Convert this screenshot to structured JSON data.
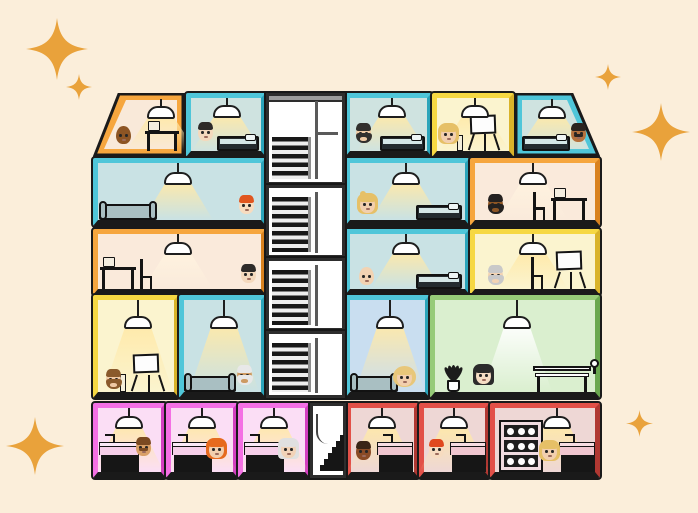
{
  "illustration": {
    "description": "Cutaway dollhouse-style illustration of a five-storey apartment building with 21 emoji-style residents, pendant lamps, furniture, a central stairwell and gold sparkles on a cream background",
    "background": "#fbeeda",
    "line_color": "#1a1a1a",
    "sparkles": {
      "color": "#e9a23b",
      "items": [
        {
          "x": 26,
          "y": 18,
          "size": 62
        },
        {
          "x": 66,
          "y": 74,
          "size": 26
        },
        {
          "x": 595,
          "y": 64,
          "size": 26
        },
        {
          "x": 632,
          "y": 103,
          "size": 58
        },
        {
          "x": 626,
          "y": 410,
          "size": 27
        },
        {
          "x": 6,
          "y": 417,
          "size": 58
        }
      ]
    },
    "stairwell": {
      "x": 266,
      "y": 93,
      "width": 79,
      "height": 305,
      "frame": "#2d2d2d",
      "roof": "#9c9c9c",
      "sections": [
        {
          "y": 93,
          "h": 92,
          "steps_top_pct": 48,
          "roof": true,
          "shelf": true
        },
        {
          "y": 185,
          "h": 73,
          "steps_top_pct": 14,
          "roof": false,
          "shelf": false
        },
        {
          "y": 258,
          "h": 73,
          "steps_top_pct": 14,
          "roof": false,
          "shelf": false
        },
        {
          "y": 331,
          "h": 67,
          "steps_top_pct": 14,
          "roof": false,
          "shelf": false
        }
      ],
      "mini": {
        "x": 310,
        "y": 403,
        "width": 36,
        "height": 75,
        "steps": 6
      }
    },
    "rooms": [
      {
        "id": "f1-attic-left",
        "floor": 1,
        "x": 93,
        "y": 93,
        "w": 92,
        "h": 64,
        "frame": "#f6a63e",
        "frame_dark": "#d9821f",
        "interior": "#f9e9d9",
        "slant": "left",
        "lamp": {
          "cx": 62,
          "cord": 7,
          "cone": "#ffe9a8"
        },
        "furniture": [
          {
            "type": "desk",
            "left": 46,
            "width": 34,
            "height": 32
          }
        ],
        "people": [
          {
            "name": "man-dark-skin-bald",
            "skin": "#8d5524",
            "hair": "",
            "style": "bald",
            "beard": false,
            "mustache": false,
            "left": 16,
            "bottom": 7
          }
        ]
      },
      {
        "id": "f1-bedroom-2",
        "floor": 1,
        "x": 186,
        "y": 93,
        "w": 80,
        "h": 64,
        "frame": "#4fc6d9",
        "frame_dark": "#2ba4ba",
        "interior": "#cfe3e0",
        "slant": "",
        "lamp": {
          "cx": 36,
          "cord": 7,
          "cone": "#ffe9a8"
        },
        "furniture": [
          {
            "type": "bed",
            "left": 26,
            "width": 42,
            "height": 15
          }
        ],
        "people": [
          {
            "name": "man-black-hair",
            "skin": "#f4d9bd",
            "hair": "#2e2b29",
            "style": "short",
            "beard": false,
            "mustache": false,
            "left": 6,
            "bottom": 10
          }
        ]
      },
      {
        "id": "f1-bedroom-3",
        "floor": 1,
        "x": 345,
        "y": 93,
        "w": 87,
        "h": 64,
        "frame": "#4fc6d9",
        "frame_dark": "#2ba4ba",
        "interior": "#cfe3e0",
        "slant": "",
        "lamp": {
          "cx": 42,
          "cord": 7,
          "cone": "#ffe9a8"
        },
        "furniture": [
          {
            "type": "bed",
            "left": 30,
            "width": 45,
            "height": 15
          }
        ],
        "people": [
          {
            "name": "man-dark-beard",
            "skin": "#efc9a4",
            "hair": "#33302e",
            "style": "short",
            "beard": true,
            "mustache": false,
            "left": 5,
            "bottom": 9
          }
        ]
      },
      {
        "id": "f1-studio-yellow",
        "floor": 1,
        "x": 432,
        "y": 93,
        "w": 82,
        "h": 64,
        "frame": "#f6d843",
        "frame_dark": "#d9b32a",
        "interior": "#fbf4cf",
        "slant": "",
        "lamp": {
          "cx": 38,
          "cord": 7,
          "cone": "#ffe9a8"
        },
        "furniture": [
          {
            "type": "easel",
            "left": 28,
            "width": 38,
            "height": 36
          },
          {
            "type": "stool",
            "left": 20,
            "width": 6,
            "height": 16
          }
        ],
        "people": [
          {
            "name": "woman-blonde",
            "skin": "#f2cfae",
            "hair": "#e6c067",
            "style": "long",
            "beard": false,
            "mustache": false,
            "left": 3,
            "bottom": 8
          }
        ]
      },
      {
        "id": "f1-attic-right",
        "floor": 1,
        "x": 514,
        "y": 93,
        "w": 86,
        "h": 64,
        "frame": "#4fc6d9",
        "frame_dark": "#2ba4ba",
        "interior": "#cfe3e0",
        "slant": "right",
        "lamp": {
          "cx": 32,
          "cord": 7,
          "cone": "#ffe9a8"
        },
        "furniture": [
          {
            "type": "bed",
            "left": 2,
            "width": 48,
            "height": 15
          }
        ],
        "people": [
          {
            "name": "man-mustache-medium-skin",
            "skin": "#b5713d",
            "hair": "#2b2420",
            "style": "short",
            "beard": false,
            "mustache": true,
            "left": 50,
            "bottom": 9
          }
        ]
      },
      {
        "id": "f2-bedroom-left",
        "floor": 2,
        "x": 93,
        "y": 158,
        "w": 173,
        "h": 68,
        "frame": "#4fc6d9",
        "frame_dark": "#2ba4ba",
        "interior": "#c9e2e4",
        "slant": "",
        "lamp": {
          "cx": 80,
          "cord": 9,
          "cone": "#ffe9a8"
        },
        "furniture": [
          {
            "type": "couch",
            "left": 1,
            "width": 58,
            "height": 16
          }
        ],
        "people": [
          {
            "name": "boy-red-hair",
            "skin": "#f7dcc0",
            "hair": "#e0561f",
            "style": "short",
            "beard": false,
            "mustache": false,
            "left": 140,
            "bottom": 6
          }
        ]
      },
      {
        "id": "f2-bedroom-mid",
        "floor": 2,
        "x": 345,
        "y": 158,
        "w": 125,
        "h": 68,
        "frame": "#4fc6d9",
        "frame_dark": "#2ba4ba",
        "interior": "#c9e2e4",
        "slant": "",
        "lamp": {
          "cx": 56,
          "cord": 9,
          "cone": "#ffe9a8"
        },
        "furniture": [
          {
            "type": "bed",
            "left": 66,
            "width": 46,
            "height": 15
          }
        ],
        "people": [
          {
            "name": "woman-blonde-ponytail",
            "skin": "#f2cfae",
            "hair": "#e6c067",
            "style": "ponytail",
            "beard": false,
            "mustache": false,
            "left": 9,
            "bottom": 7
          }
        ]
      },
      {
        "id": "f2-office-orange",
        "floor": 2,
        "x": 470,
        "y": 158,
        "w": 130,
        "h": 68,
        "frame": "#f6a63e",
        "frame_dark": "#d9821f",
        "interior": "#faeadb",
        "slant": "",
        "lamp": {
          "cx": 58,
          "cord": 9,
          "cone": "#fff3df"
        },
        "furniture": [
          {
            "type": "chair",
            "left": 58,
            "width": 14,
            "height": 28
          },
          {
            "type": "desk",
            "left": 76,
            "width": 36,
            "height": 34
          }
        ],
        "people": [
          {
            "name": "man-dark-skin-beard",
            "skin": "#8d5524",
            "hair": "#242120",
            "style": "short",
            "beard": true,
            "mustache": false,
            "left": 12,
            "bottom": 7
          }
        ]
      },
      {
        "id": "f3-office-left",
        "floor": 3,
        "x": 93,
        "y": 229,
        "w": 173,
        "h": 66,
        "frame": "#f6a63e",
        "frame_dark": "#d9821f",
        "interior": "#faeadb",
        "slant": "",
        "lamp": {
          "cx": 80,
          "cord": 8,
          "cone": "#fff3df"
        },
        "furniture": [
          {
            "type": "desk",
            "left": 2,
            "width": 36,
            "height": 34
          },
          {
            "type": "chair",
            "left": 42,
            "width": 14,
            "height": 30
          }
        ],
        "people": [
          {
            "name": "boy-black-hair",
            "skin": "#f4d9bd",
            "hair": "#2e2b29",
            "style": "short",
            "beard": false,
            "mustache": false,
            "left": 142,
            "bottom": 6
          }
        ]
      },
      {
        "id": "f3-bedroom-mid",
        "floor": 3,
        "x": 345,
        "y": 229,
        "w": 125,
        "h": 66,
        "frame": "#4fc6d9",
        "frame_dark": "#2ba4ba",
        "interior": "#c9e2e4",
        "slant": "",
        "lamp": {
          "cx": 56,
          "cord": 8,
          "cone": "#ffe9a8"
        },
        "furniture": [
          {
            "type": "bed",
            "left": 66,
            "width": 46,
            "height": 15
          }
        ],
        "people": [
          {
            "name": "older-person-bald",
            "skin": "#f2d3b3",
            "hair": "",
            "style": "bald",
            "beard": false,
            "mustache": false,
            "left": 8,
            "bottom": 4
          }
        ]
      },
      {
        "id": "f3-studio-yellow",
        "floor": 3,
        "x": 470,
        "y": 229,
        "w": 130,
        "h": 66,
        "frame": "#f6d843",
        "frame_dark": "#d9b32a",
        "interior": "#fbf4cf",
        "slant": "",
        "lamp": {
          "cx": 58,
          "cord": 8,
          "cone": "#ffe9a8"
        },
        "furniture": [
          {
            "type": "chair",
            "left": 56,
            "width": 14,
            "height": 32
          },
          {
            "type": "easel",
            "left": 76,
            "width": 38,
            "height": 38
          }
        ],
        "people": [
          {
            "name": "older-man-gray-beard",
            "skin": "#f2d3b3",
            "hair": "#c9c9c9",
            "style": "short",
            "beard": true,
            "mustache": false,
            "left": 12,
            "bottom": 5
          }
        ]
      },
      {
        "id": "f4-studio-yellow",
        "floor": 4,
        "x": 93,
        "y": 295,
        "w": 86,
        "h": 103,
        "frame": "#f6d843",
        "frame_dark": "#d9b32a",
        "interior": "#fbf4cf",
        "slant": "",
        "lamp": {
          "cx": 40,
          "cord": 16,
          "cone": "#ffe9a8"
        },
        "furniture": [
          {
            "type": "easel",
            "left": 30,
            "width": 40,
            "height": 38
          },
          {
            "type": "stool",
            "left": 22,
            "width": 6,
            "height": 18
          }
        ],
        "people": [
          {
            "name": "man-brown-beard",
            "skin": "#efc9a4",
            "hair": "#8a5a2b",
            "style": "short",
            "beard": true,
            "mustache": false,
            "left": 7,
            "bottom": 4
          }
        ]
      },
      {
        "id": "f4-lounge-teal",
        "floor": 4,
        "x": 179,
        "y": 295,
        "w": 87,
        "h": 103,
        "frame": "#4fc6d9",
        "frame_dark": "#2ba4ba",
        "interior": "#c9e2e4",
        "slant": "",
        "lamp": {
          "cx": 40,
          "cord": 16,
          "cone": "#ffe9a8"
        },
        "furniture": [
          {
            "type": "couch",
            "left": 0,
            "width": 52,
            "height": 16
          }
        ],
        "people": [
          {
            "name": "older-man-white-beard",
            "skin": "#cd9a62",
            "hair": "#e8e8e8",
            "style": "short",
            "beard": true,
            "mustache": false,
            "left": 52,
            "bottom": 8
          }
        ]
      },
      {
        "id": "f4-lounge-blue",
        "floor": 4,
        "x": 345,
        "y": 295,
        "w": 85,
        "h": 103,
        "frame": "#4fc6d9",
        "frame_dark": "#2ba4ba",
        "interior": "#c9def0",
        "slant": "",
        "lamp": {
          "cx": 40,
          "cord": 16,
          "cone": "#ffe9a8"
        },
        "furniture": [
          {
            "type": "couch",
            "left": 0,
            "width": 48,
            "height": 16
          }
        ],
        "people": [
          {
            "name": "woman-blonde-curly",
            "skin": "#f2cfae",
            "hair": "#e8c77a",
            "style": "curly",
            "beard": false,
            "mustache": false,
            "left": 46,
            "bottom": 6
          }
        ]
      },
      {
        "id": "f4-lounge-green",
        "floor": 4,
        "x": 430,
        "y": 295,
        "w": 170,
        "h": 103,
        "frame": "#96cb78",
        "frame_dark": "#6aa84f",
        "interior": "#daefcf",
        "slant": "",
        "lamp": {
          "cx": 82,
          "cord": 16,
          "cone": "#ffffff"
        },
        "furniture": [
          {
            "type": "plant",
            "left": 8,
            "width": 22,
            "height": 44
          },
          {
            "type": "bench",
            "left": 98,
            "width": 58,
            "height": 26
          }
        ],
        "people": [
          {
            "name": "woman-black-bob",
            "skin": "#f5ddc4",
            "hair": "#2b2b2b",
            "style": "bob",
            "beard": false,
            "mustache": false,
            "left": 40,
            "bottom": 8
          }
        ]
      },
      {
        "id": "f5-pink-1",
        "floor": 5,
        "x": 93,
        "y": 403,
        "w": 73,
        "h": 75,
        "frame": "#f470e4",
        "frame_dark": "#d33fc0",
        "interior": "#fbdef5",
        "slant": "",
        "lamp": {
          "cx": 31,
          "cord": 8,
          "cone": "#ffe9a8"
        },
        "furniture": [
          {
            "type": "counter",
            "left": 1,
            "width": 40,
            "height": 40,
            "variant": "pink"
          }
        ],
        "people": [
          {
            "name": "man-brown-mustache",
            "skin": "#d9a066",
            "hair": "#7b4a21",
            "style": "short",
            "beard": false,
            "mustache": true,
            "left": 37,
            "bottom": 16
          }
        ]
      },
      {
        "id": "f5-pink-2",
        "floor": 5,
        "x": 166,
        "y": 403,
        "w": 72,
        "h": 75,
        "frame": "#f470e4",
        "frame_dark": "#d33fc0",
        "interior": "#fbdef5",
        "slant": "",
        "lamp": {
          "cx": 31,
          "cord": 8,
          "cone": "#ffe9a8"
        },
        "furniture": [
          {
            "type": "counter",
            "left": 1,
            "width": 40,
            "height": 40,
            "variant": "pink"
          }
        ],
        "people": [
          {
            "name": "woman-orange-hair",
            "skin": "#f2cfae",
            "hair": "#e66a1e",
            "style": "long",
            "beard": false,
            "mustache": false,
            "left": 37,
            "bottom": 14
          }
        ]
      },
      {
        "id": "f5-pink-3",
        "floor": 5,
        "x": 238,
        "y": 403,
        "w": 72,
        "h": 75,
        "frame": "#f470e4",
        "frame_dark": "#d33fc0",
        "interior": "#fbdef5",
        "slant": "",
        "lamp": {
          "cx": 31,
          "cord": 8,
          "cone": "#ffe9a8"
        },
        "furniture": [
          {
            "type": "counter",
            "left": 1,
            "width": 40,
            "height": 40,
            "variant": "pink"
          }
        ],
        "people": [
          {
            "name": "older-woman-white-hair",
            "skin": "#f2d3b8",
            "hair": "#e0e0e0",
            "style": "bob",
            "beard": false,
            "mustache": false,
            "left": 37,
            "bottom": 14
          }
        ]
      },
      {
        "id": "f5-red-1",
        "floor": 5,
        "x": 346,
        "y": 403,
        "w": 73,
        "h": 75,
        "frame": "#e25048",
        "frame_dark": "#b03832",
        "interior": "#eed7d5",
        "slant": "",
        "lamp": {
          "cx": 31,
          "cord": 8,
          "cone": "#ffe9a8"
        },
        "furniture": [
          {
            "type": "counter",
            "left": 26,
            "width": 36,
            "height": 40,
            "variant": "red"
          }
        ],
        "people": [
          {
            "name": "person-dark-skin",
            "skin": "#8a4b26",
            "hair": "#3a2417",
            "style": "short",
            "beard": false,
            "mustache": false,
            "left": 4,
            "bottom": 12
          }
        ]
      },
      {
        "id": "f5-red-2",
        "floor": 5,
        "x": 419,
        "y": 403,
        "w": 71,
        "h": 75,
        "frame": "#e25048",
        "frame_dark": "#b03832",
        "interior": "#eed7d5",
        "slant": "",
        "lamp": {
          "cx": 30,
          "cord": 8,
          "cone": "#ffe9a8"
        },
        "furniture": [
          {
            "type": "counter",
            "left": 26,
            "width": 36,
            "height": 40,
            "variant": "red"
          }
        ],
        "people": [
          {
            "name": "man-red-hair",
            "skin": "#f7dcc0",
            "hair": "#e0491f",
            "style": "short",
            "beard": false,
            "mustache": false,
            "left": 4,
            "bottom": 14
          }
        ]
      },
      {
        "id": "f5-red-3-cellar",
        "floor": 5,
        "x": 490,
        "y": 403,
        "w": 110,
        "h": 75,
        "frame": "#e25048",
        "frame_dark": "#b03832",
        "interior": "#eed7d5",
        "slant": "",
        "lamp": {
          "cx": 62,
          "cord": 8,
          "cone": "#ffe9a8"
        },
        "furniture": [
          {
            "type": "rack",
            "left": 4,
            "width": 44,
            "height": 52,
            "rows": 3,
            "cols": 3
          },
          {
            "type": "counter",
            "left": 64,
            "width": 36,
            "height": 40,
            "variant": "red"
          }
        ],
        "people": [
          {
            "name": "woman-blonde-2",
            "skin": "#f2cfae",
            "hair": "#e6c067",
            "style": "long",
            "beard": false,
            "mustache": false,
            "left": 46,
            "bottom": 12
          }
        ]
      }
    ]
  }
}
